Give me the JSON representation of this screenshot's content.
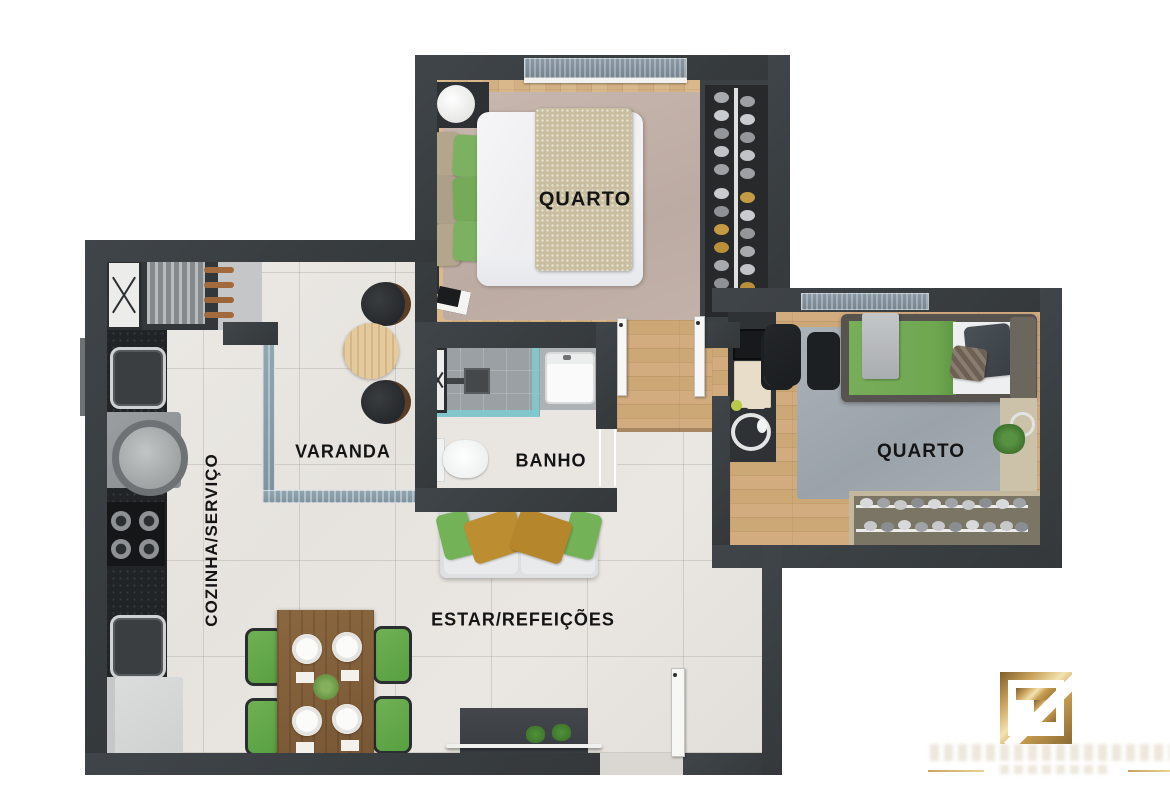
{
  "document": {
    "type": "apartment-floor-plan-render",
    "language": "pt-BR"
  },
  "rooms": {
    "bedroom1": {
      "label": "QUARTO"
    },
    "bedroom2": {
      "label": "QUARTO"
    },
    "balcony": {
      "label": "VARANDA"
    },
    "bathroom": {
      "label": "BANHO"
    },
    "living_dining": {
      "label": "ESTAR/REFEIÇÕES"
    },
    "kitchen_service": {
      "label": "COZINHA/SERVIÇO"
    }
  },
  "colors": {
    "wall": "#3b4043",
    "tile_floor": "#e8e5e0",
    "wood_floor": "#d2ab7e",
    "glass": "#8aa0ac",
    "accent_green": "#74b258",
    "accent_mustard": "#bd8d31",
    "rug_bedroom1": "#c1b0a7",
    "rug_bedroom2": "#a6adb3",
    "logo_gold": "#c9a050"
  },
  "branding": {
    "monogram": "Z",
    "style": "gold-gradient-square",
    "tagline_legible": false
  }
}
